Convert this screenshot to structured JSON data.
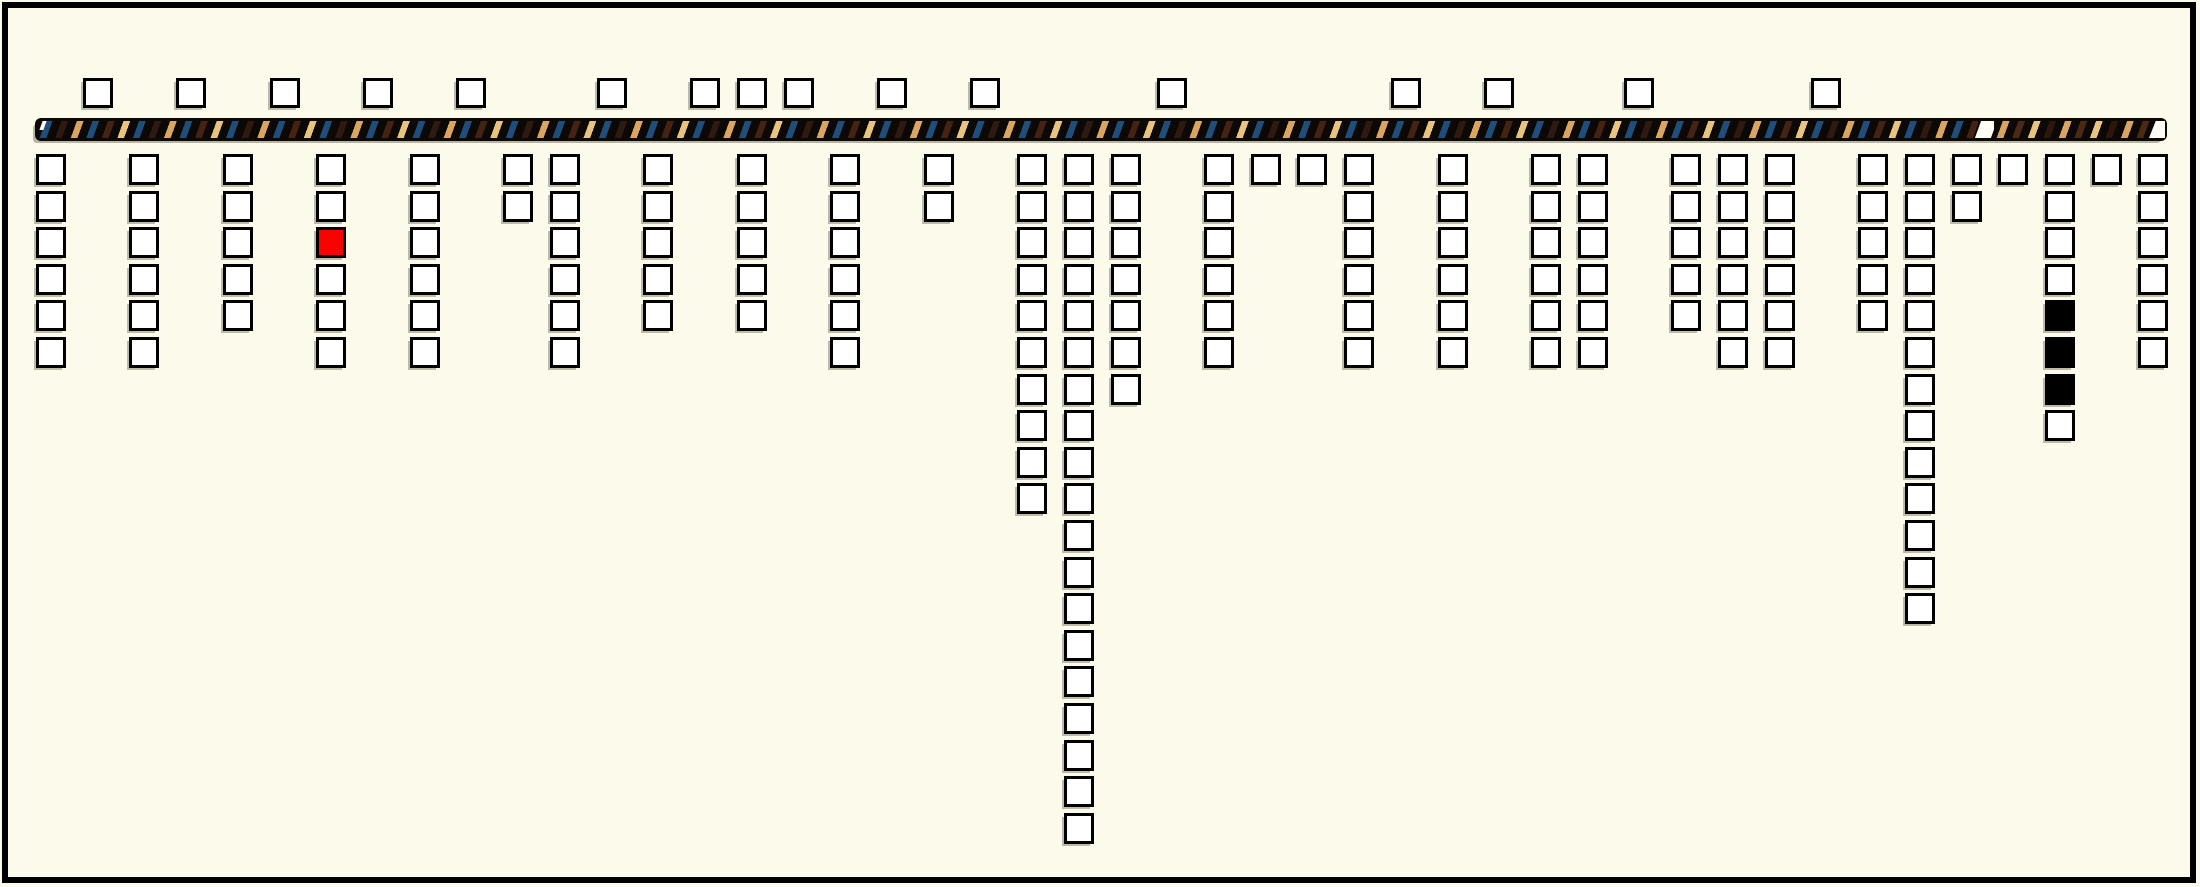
{
  "canvas": {
    "width": 2200,
    "height": 887,
    "background": "#FCFAEA",
    "frame_color": "#000000",
    "frame_thickness": 6
  },
  "colors": {
    "square_fill": "#FFFFFF",
    "square_border": "#000000",
    "shadow": "#7D7A64",
    "highlight_red": "#F60400",
    "filled_black": "#000000",
    "bar_base": "#0B0805",
    "stripe_blue": "#1F4E7A",
    "stripe_brown_dark": "#2E1A10",
    "stripe_maroon": "#442312",
    "stripe_brown": "#4A2A15",
    "stripe_tan": "#D9A55F",
    "stripe_tan_light": "#E9C47E",
    "mark_white": "#FDFDF6"
  },
  "grid": {
    "x0": 36,
    "slot_pitch": 46.72,
    "square_w": 30,
    "square_h": 31,
    "top_row_y": 78,
    "below_first_row_y": 154,
    "row_pitch": 36.6
  },
  "bar": {
    "x": 35,
    "y": 118,
    "width": 2132,
    "height": 23,
    "segments": [
      {
        "type": "stripes",
        "palette": "palA",
        "rel_x": 2,
        "width": 1941
      },
      {
        "type": "white_mark",
        "rel_x": 1943,
        "width": 16
      },
      {
        "type": "stripes",
        "palette": "palB",
        "rel_x": 1959,
        "width": 156
      },
      {
        "type": "white_end_wedge",
        "rel_x": 2114,
        "width": 16
      }
    ],
    "start_tick": {
      "rel_x": 6,
      "rel_y": 3,
      "width": 4,
      "height": 9
    }
  },
  "top_marks": {
    "slots": [
      1,
      3,
      5,
      7,
      9,
      12,
      14,
      15,
      16,
      18,
      20,
      24,
      29,
      31,
      34,
      38
    ],
    "count": 16
  },
  "columns": [
    {
      "slot": 0,
      "count": 6
    },
    {
      "slot": 2,
      "count": 6
    },
    {
      "slot": 4,
      "count": 5
    },
    {
      "slot": 6,
      "count": 6,
      "special": {
        "3": "red"
      }
    },
    {
      "slot": 8,
      "count": 6
    },
    {
      "slot": 10,
      "count": 2
    },
    {
      "slot": 11,
      "count": 6
    },
    {
      "slot": 13,
      "count": 5
    },
    {
      "slot": 15,
      "count": 5
    },
    {
      "slot": 17,
      "count": 6
    },
    {
      "slot": 19,
      "count": 2
    },
    {
      "slot": 21,
      "count": 10
    },
    {
      "slot": 22,
      "count": 19
    },
    {
      "slot": 23,
      "count": 7
    },
    {
      "slot": 25,
      "count": 6
    },
    {
      "slot": 26,
      "count": 1
    },
    {
      "slot": 27,
      "count": 1
    },
    {
      "slot": 28,
      "count": 6
    },
    {
      "slot": 30,
      "count": 6
    },
    {
      "slot": 32,
      "count": 6
    },
    {
      "slot": 33,
      "count": 6
    },
    {
      "slot": 35,
      "count": 5
    },
    {
      "slot": 36,
      "count": 6
    },
    {
      "slot": 37,
      "count": 6
    },
    {
      "slot": 39,
      "count": 5
    },
    {
      "slot": 40,
      "count": 13
    },
    {
      "slot": 41,
      "count": 2
    },
    {
      "slot": 42,
      "count": 1
    },
    {
      "slot": 43,
      "count": 8,
      "special": {
        "5": "black",
        "6": "black",
        "7": "black"
      }
    },
    {
      "slot": 44,
      "count": 1
    },
    {
      "slot": 45,
      "count": 6
    }
  ],
  "summary": {
    "squares_above_bar": 16,
    "squares_below_bar": 176,
    "red_squares": 1,
    "black_squares": 3
  }
}
